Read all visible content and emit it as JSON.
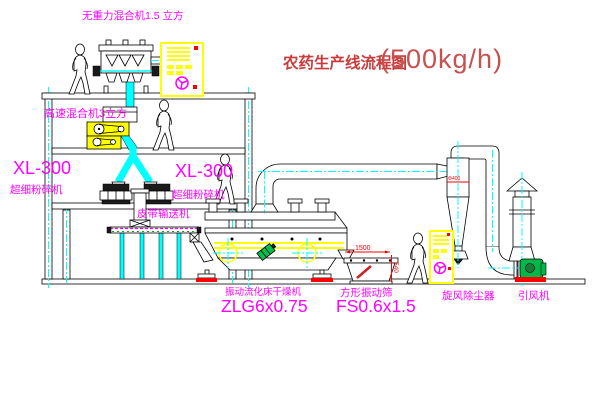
{
  "title": {
    "text": "农药生产线流程图",
    "capacity": "(500kg/h)"
  },
  "labels": {
    "gravity_mixer": "无重力混合机1.5 立方",
    "high_speed_mixer": "高速混合机3立方",
    "pulverizer_left_model": "XL-300",
    "pulverizer_left_name": "超细粉碎机",
    "pulverizer_center_model": "XL-300",
    "pulverizer_center_name": "超细粉碎机",
    "belt_conveyor": "皮带输送机",
    "dryer_name": "振动流化床干燥机",
    "dryer_model": "ZLG6x0.75",
    "sieve_name": "方形振动筛",
    "sieve_model": "FS0.6x1.5",
    "cyclone": "旋风除尘器",
    "fan": "引风机"
  },
  "dims": {
    "length": "1500",
    "height": "540",
    "cyclone_dia": "Φ400"
  },
  "colors": {
    "label_magenta": "#ff00ff",
    "title_red": "#c83c3c",
    "centerline_cyan": "#00ffff",
    "highlight_yellow": "#ffff00",
    "accent_red": "#ff0000",
    "machine_green": "#00b84a",
    "line_black": "#000000"
  }
}
